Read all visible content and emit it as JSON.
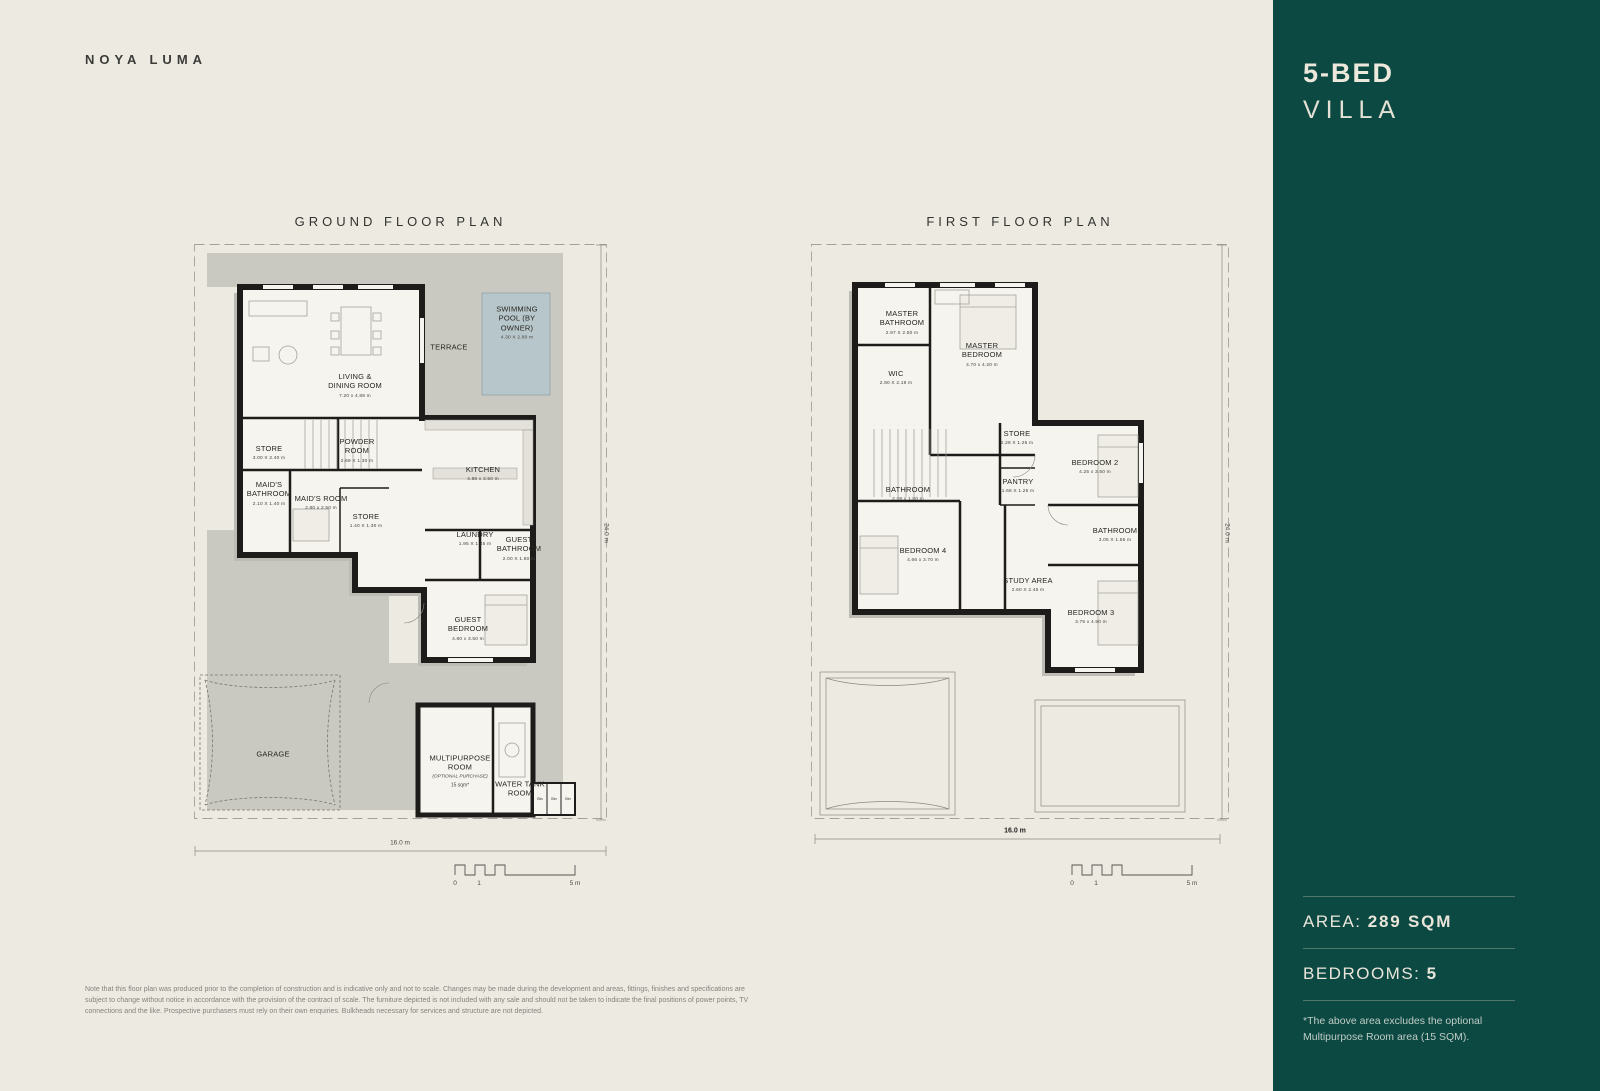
{
  "brand": "NOYA LUMA",
  "sidebar": {
    "title_line1": "5-BED",
    "title_line2": "VILLA",
    "area_label": "AREA: ",
    "area_value": "289 SQM",
    "bedrooms_label": "BEDROOMS: ",
    "bedrooms_value": "5",
    "footnote": "*The above area excludes the optional Multipurpose Room area (15 SQM).",
    "bg_color": "#0c4942",
    "text_color": "#ece8dc"
  },
  "plans": {
    "ground": {
      "title": "GROUND FLOOR PLAN",
      "bottom_dim": "16.0 m",
      "side_dim": "24.0 m",
      "scale_labels": [
        "0",
        "1",
        "5 m"
      ],
      "rooms": [
        {
          "label": "SWIMMING\nPOOL (BY\nOWNER)",
          "dims": "4.30 X 2.80 m",
          "x": 324,
          "y": 80
        },
        {
          "label": "TERRACE",
          "x": 256,
          "y": 104
        },
        {
          "label": "LIVING &\nDINING ROOM",
          "dims": "7.20 x 4.88 m",
          "x": 162,
          "y": 143
        },
        {
          "label": "STORE",
          "dims": "3.00 X 2.40 m",
          "x": 76,
          "y": 210
        },
        {
          "label": "POWDER\nROOM",
          "dims": "2.69 X 1.30 m",
          "x": 164,
          "y": 208
        },
        {
          "label": "MAID'S\nBATHROOM",
          "dims": "2.10 X 1.40 m",
          "x": 76,
          "y": 251
        },
        {
          "label": "MAID'S ROOM",
          "dims": "2.80 x 2.50 m",
          "x": 128,
          "y": 260
        },
        {
          "label": "STORE",
          "dims": "1.40 X 1.30 m",
          "x": 173,
          "y": 278
        },
        {
          "label": "KITCHEN",
          "dims": "4.88 x 3.50 m",
          "x": 290,
          "y": 231
        },
        {
          "label": "LAUNDRY",
          "dims": "1.95 X 1.45 m",
          "x": 282,
          "y": 296
        },
        {
          "label": "GUEST\nBATHROOM",
          "dims": "2.00 X 1.80 m",
          "x": 326,
          "y": 306
        },
        {
          "label": "GUEST\nBEDROOM",
          "dims": "4.80 x 3.50 m",
          "x": 275,
          "y": 386
        },
        {
          "label": "GARAGE",
          "x": 80,
          "y": 511
        },
        {
          "label": "MULTIPURPOSE\nROOM",
          "sub": "(OPTIONAL PURCHASE)",
          "note": "15 sqm*",
          "x": 267,
          "y": 528
        },
        {
          "label": "WATER TANK\nROOM",
          "x": 327,
          "y": 546
        },
        {
          "label": "Bin",
          "tiny": true,
          "x": 347,
          "y": 556
        },
        {
          "label": "Bin",
          "tiny": true,
          "x": 361,
          "y": 556
        },
        {
          "label": "Bin",
          "tiny": true,
          "x": 375,
          "y": 556
        }
      ]
    },
    "first": {
      "title": "FIRST FLOOR PLAN",
      "bottom_dim": "16.0 m",
      "side_dim": "24.0 m",
      "scale_labels": [
        "0",
        "1",
        "5 m"
      ],
      "rooms": [
        {
          "label": "MASTER\nBATHROOM",
          "dims": "2.97 X 2.50 m",
          "x": 92,
          "y": 80
        },
        {
          "label": "MASTER\nBEDROOM",
          "dims": "4.70 x 4.20 m",
          "x": 172,
          "y": 112
        },
        {
          "label": "WIC",
          "dims": "2.90 X 2.19 m",
          "x": 86,
          "y": 135
        },
        {
          "label": "STORE",
          "dims": "2.28 X 1.25 m",
          "x": 207,
          "y": 195
        },
        {
          "label": "BEDROOM 2",
          "dims": "4.25 x 3.50 m",
          "x": 285,
          "y": 224
        },
        {
          "label": "PANTRY",
          "dims": "1.68 X 1.25 m",
          "x": 208,
          "y": 243
        },
        {
          "label": "BATHROOM",
          "dims": "2.08 x 1.80 m",
          "x": 98,
          "y": 251
        },
        {
          "label": "BATHROOM",
          "dims": "3.05 X 1.65 m",
          "x": 305,
          "y": 292
        },
        {
          "label": "BEDROOM 4",
          "dims": "4.66 x 3.70 m",
          "x": 113,
          "y": 312
        },
        {
          "label": "STUDY AREA",
          "dims": "2.60 X 2.45 m",
          "x": 218,
          "y": 342
        },
        {
          "label": "BEDROOM 3",
          "dims": "3.75 x 4.50 m",
          "x": 281,
          "y": 374
        }
      ]
    }
  },
  "disclaimer": "Note that this floor plan was produced prior to the completion of construction and is indicative only and not to scale. Changes may be made during the development and areas, fittings, finishes and specifications are subject to change without notice in accordance with the provision of the contract of scale. The furniture depicted is not included with any sale and should not be taken to indicate the final positions of power points, TV connections and the like. Prospective purchasers must rely on their own enquiries. Bulkheads necessary for services and structure are not depicted."
}
